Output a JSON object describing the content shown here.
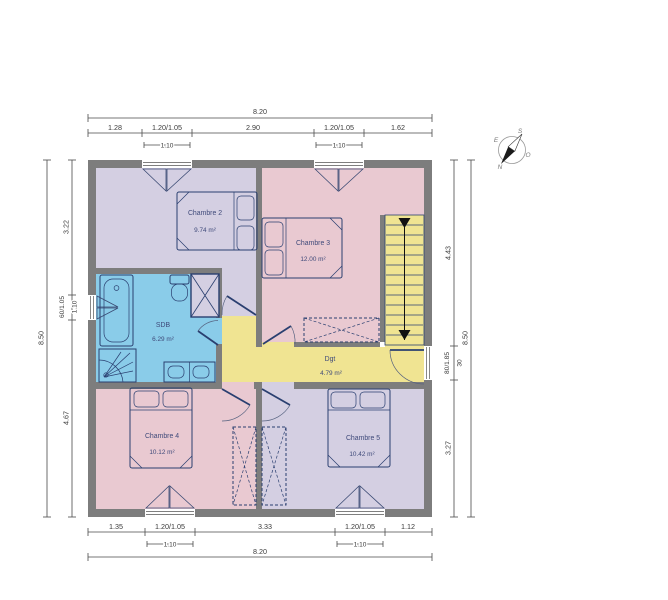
{
  "rooms": [
    {
      "name": "Chambre 2",
      "area": "9.74 m²"
    },
    {
      "name": "Chambre 3",
      "area": "12.00 m²"
    },
    {
      "name": "SDB",
      "area": "6.29 m²"
    },
    {
      "name": "Dgt",
      "area": "4.79 m²"
    },
    {
      "name": "Chambre 4",
      "area": "10.12 m²"
    },
    {
      "name": "Chambre 5",
      "area": "10.42 m²"
    }
  ],
  "dims": {
    "top": {
      "total": "8.20",
      "segs": [
        "1.28",
        "1.20/1.05",
        "2.90",
        "1.20/1.05",
        "1.62"
      ],
      "sub1": "1.10",
      "sub2": "1.10"
    },
    "bottom": {
      "total": "8.20",
      "segs": [
        "1.35",
        "1.20/1.05",
        "3.33",
        "1.20/1.05",
        "1.12"
      ],
      "sub1": "1.10",
      "sub2": "1.10"
    },
    "left": {
      "total": "8.50",
      "segs": [
        "3.22",
        "60/1.05",
        "4.67"
      ],
      "sub": "1.10"
    },
    "right": {
      "total": "8.50",
      "segs": [
        "4.43",
        "80/1.85",
        "3.27"
      ],
      "sub": "30"
    }
  },
  "compass": {
    "n": "N",
    "s": "S",
    "e": "E",
    "o": "O"
  },
  "colors": {
    "wall": "#7d7d7d",
    "room_lavender": "#d4cfe2",
    "room_pink": "#e9c9d1",
    "room_blue": "#8acce9",
    "corridor_yellow": "#f0e492",
    "line_navy": "#2a3f70",
    "dim_text": "#3b3b3b"
  }
}
